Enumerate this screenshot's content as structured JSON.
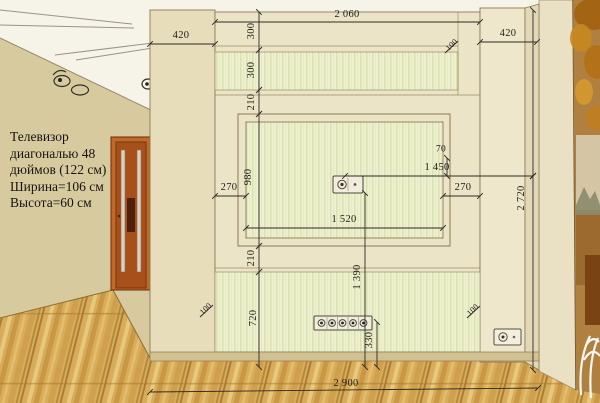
{
  "tv_note": {
    "lines": [
      "Телевизор",
      "диагональю 48",
      "дюймов (122 см)",
      "Ширина=106 см",
      "Высота=60 см"
    ]
  },
  "dimensions": {
    "top_width": "2 060",
    "left_column_width": "420",
    "right_column_width": "420",
    "upper_band_1": "300",
    "upper_band_2": "300",
    "gap_above_niche": "210",
    "niche_height": "980",
    "niche_margin_left": "270",
    "niche_margin_right": "270",
    "socket_offset": "70",
    "socket_to_corner": "1 450",
    "niche_width": "1 520",
    "gap_below_niche": "210",
    "tv_socket_height": "1 390",
    "lower_band": "720",
    "outlet_strip_height": "330",
    "wall_total_width": "2 900",
    "wall_total_height": "2 720",
    "depth_marker_top": "100",
    "depth_marker_left": "100",
    "depth_marker_right": "100"
  },
  "colors": {
    "room_wall": "#d7ca9e",
    "panel_face": "#ece4c7",
    "stripe_band": "#eef0d2",
    "floor_wood": "#d8ac5a",
    "door_wood": "#a8501a",
    "dimension_ink": "#2e2a26"
  }
}
